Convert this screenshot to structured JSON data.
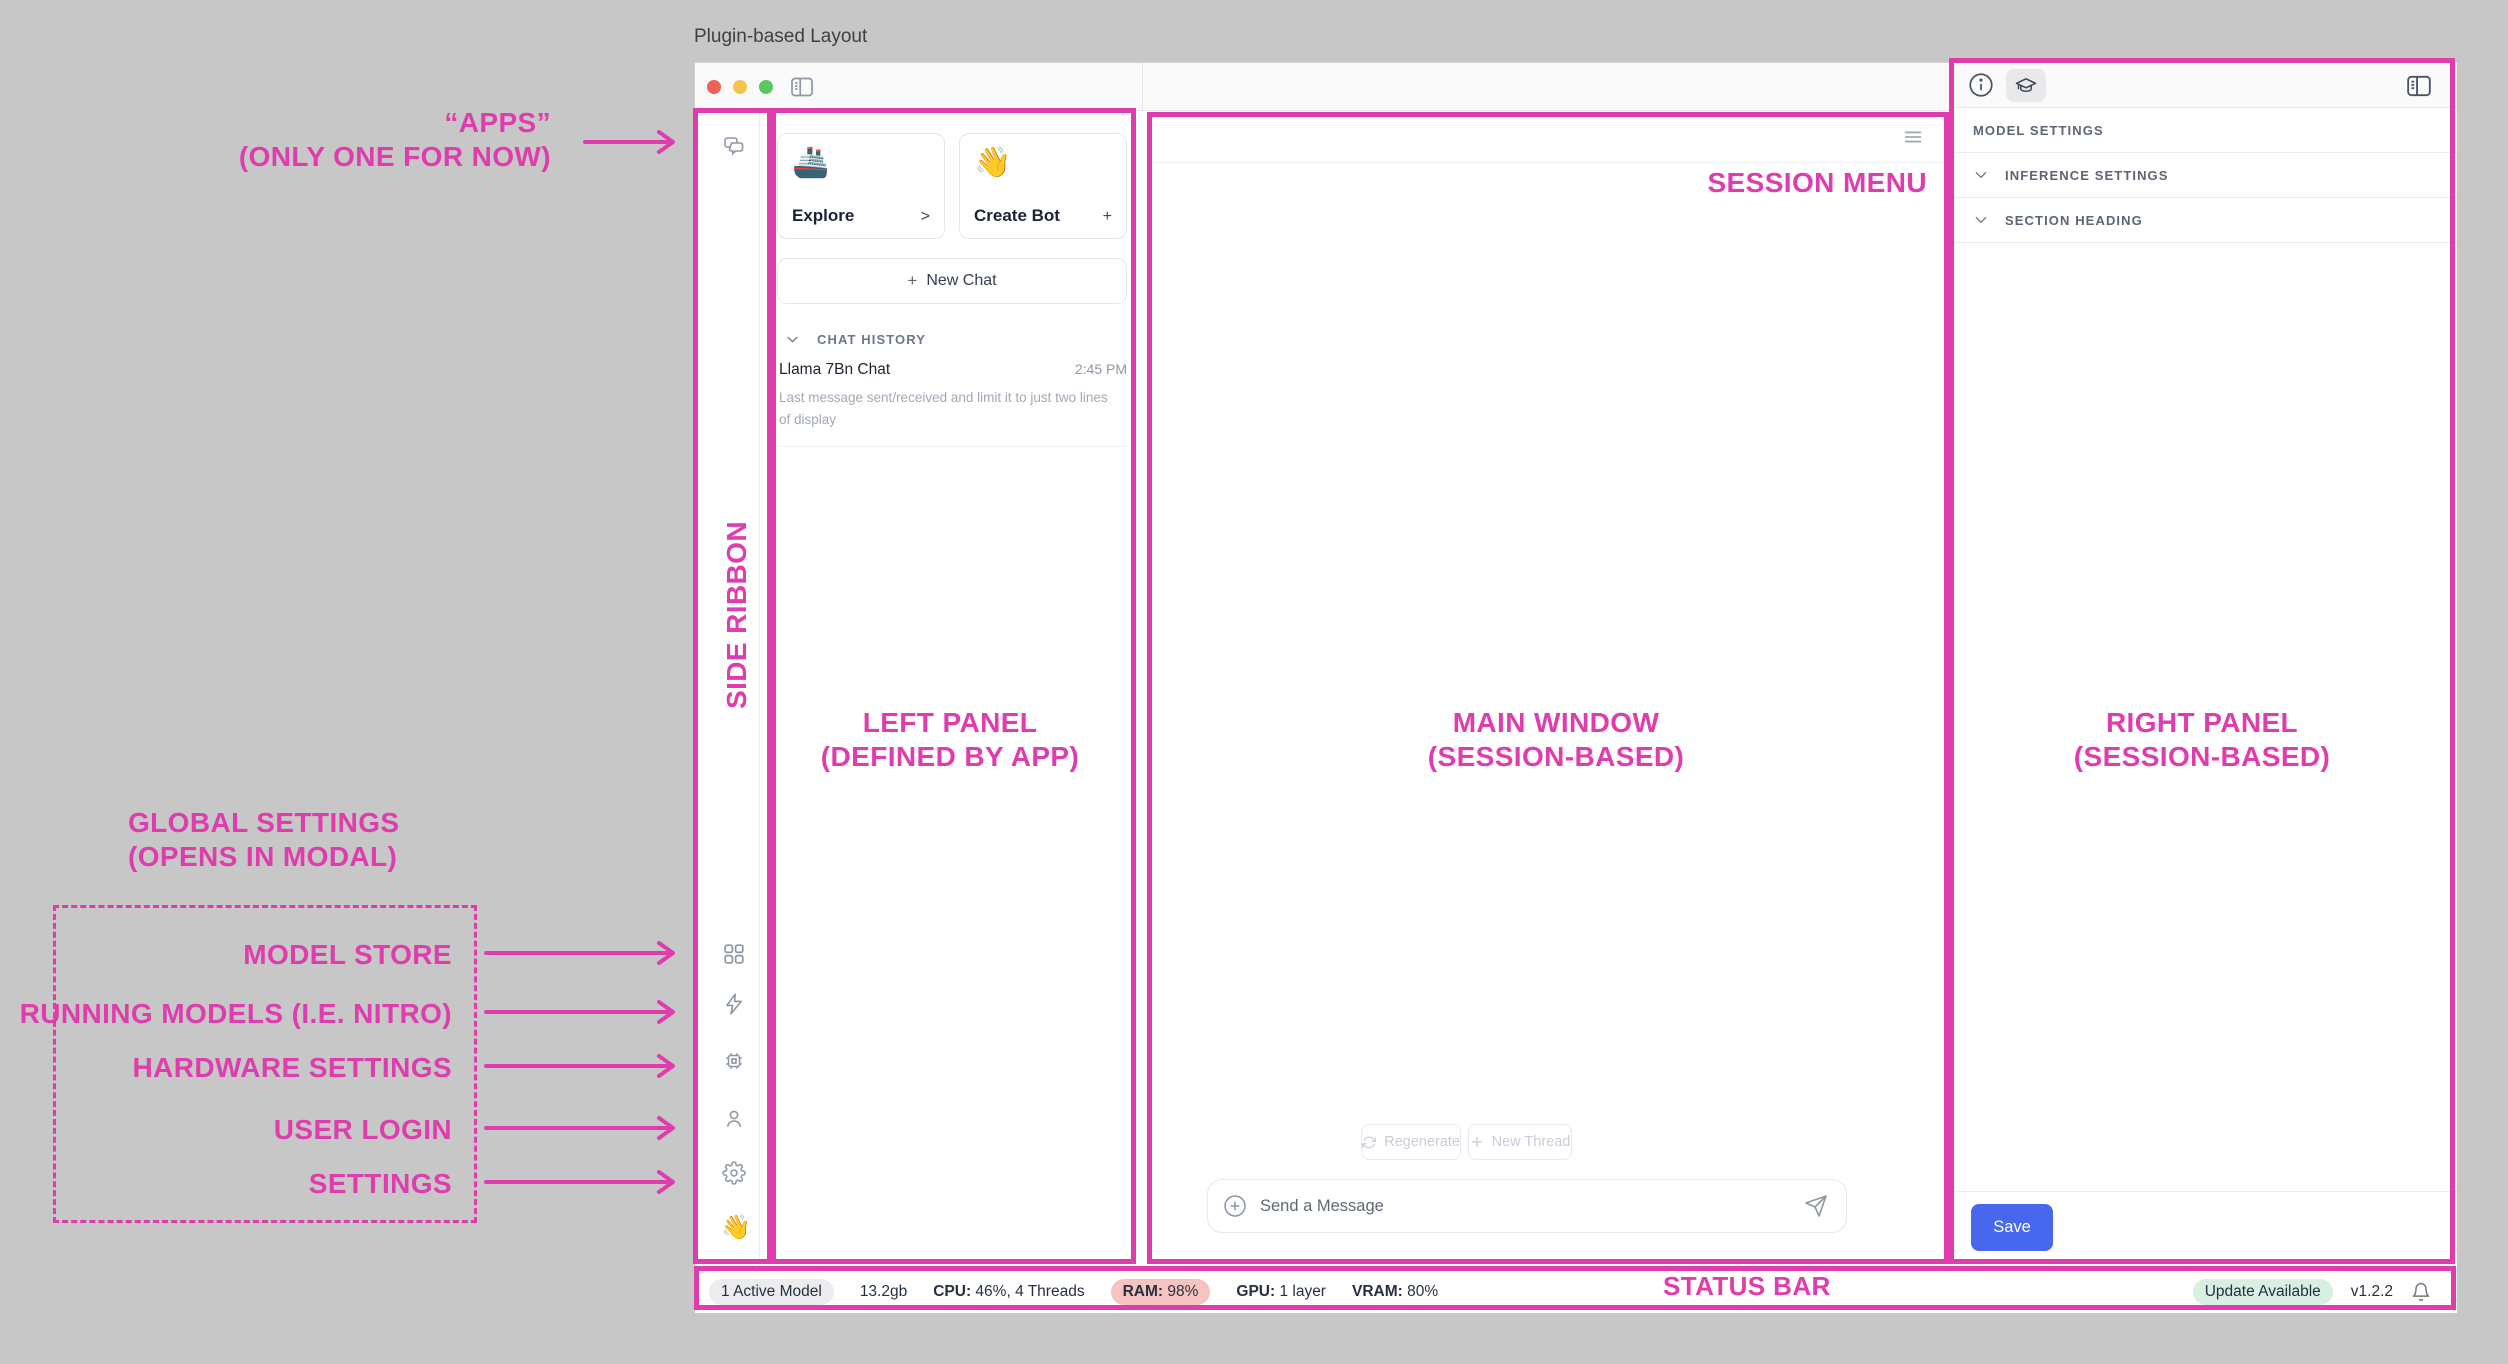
{
  "canvas": {
    "title": "Plugin-based Layout"
  },
  "colors": {
    "annotation_pink": "#df3cae",
    "save_button_blue": "#4767ee",
    "ram_badge": "#f5c4c0",
    "update_badge": "#d7f0e2",
    "active_model_badge": "#ececee",
    "traffic_red": "#ee6055",
    "traffic_yellow": "#f6c350",
    "traffic_green": "#58c85f"
  },
  "annotations": {
    "apps": {
      "line1": "“APPS”",
      "line2": "(ONLY ONE FOR NOW)"
    },
    "side_ribbon": "SIDE RIBBON",
    "global_settings": {
      "line1": "GLOBAL SETTINGS",
      "line2": "(OPENS IN MODAL)"
    },
    "modal_items": [
      "MODEL STORE",
      "RUNNING MODELS (I.E. NITRO)",
      "HARDWARE SETTINGS",
      "USER LOGIN",
      "SETTINGS"
    ],
    "left_panel": {
      "line1": "LEFT PANEL",
      "line2": "(DEFINED BY APP)"
    },
    "main_window": {
      "line1": "MAIN WINDOW",
      "line2": "(SESSION-BASED)"
    },
    "right_panel": {
      "line1": "RIGHT PANEL",
      "line2": "(SESSION-BASED)"
    },
    "session_menu": "SESSION MENU",
    "status_bar": "STATUS BAR"
  },
  "ribbon": {
    "bottom_emoji": "👋"
  },
  "left_panel": {
    "cards": [
      {
        "emoji": "🚢",
        "label": "Explore",
        "accessory": ">"
      },
      {
        "emoji": "👋",
        "label": "Create Bot",
        "accessory": "+"
      }
    ],
    "new_chat": {
      "plus": "+",
      "label": "New Chat"
    },
    "chat_history": {
      "header": "CHAT HISTORY",
      "items": [
        {
          "title": "Llama 7Bn Chat",
          "time": "2:45 PM",
          "preview": "Last message sent/received and limit it to just two lines of display"
        }
      ]
    }
  },
  "main": {
    "regenerate": "Regenerate",
    "new_thread": "New Thread",
    "composer_placeholder": "Send a Message"
  },
  "right_panel": {
    "header": "MODEL SETTINGS",
    "rows": [
      "INFERENCE SETTINGS",
      "SECTION HEADING"
    ],
    "save": "Save"
  },
  "status_bar": {
    "active_model": "1 Active Model",
    "size": "13.2gb",
    "cpu_label": "CPU:",
    "cpu_value": " 46%, 4 Threads",
    "ram_label": "RAM:",
    "ram_value": " 98%",
    "gpu_label": "GPU:",
    "gpu_value": " 1 layer",
    "vram_label": "VRAM:",
    "vram_value": " 80%",
    "update": "Update Available",
    "version": "v1.2.2"
  }
}
